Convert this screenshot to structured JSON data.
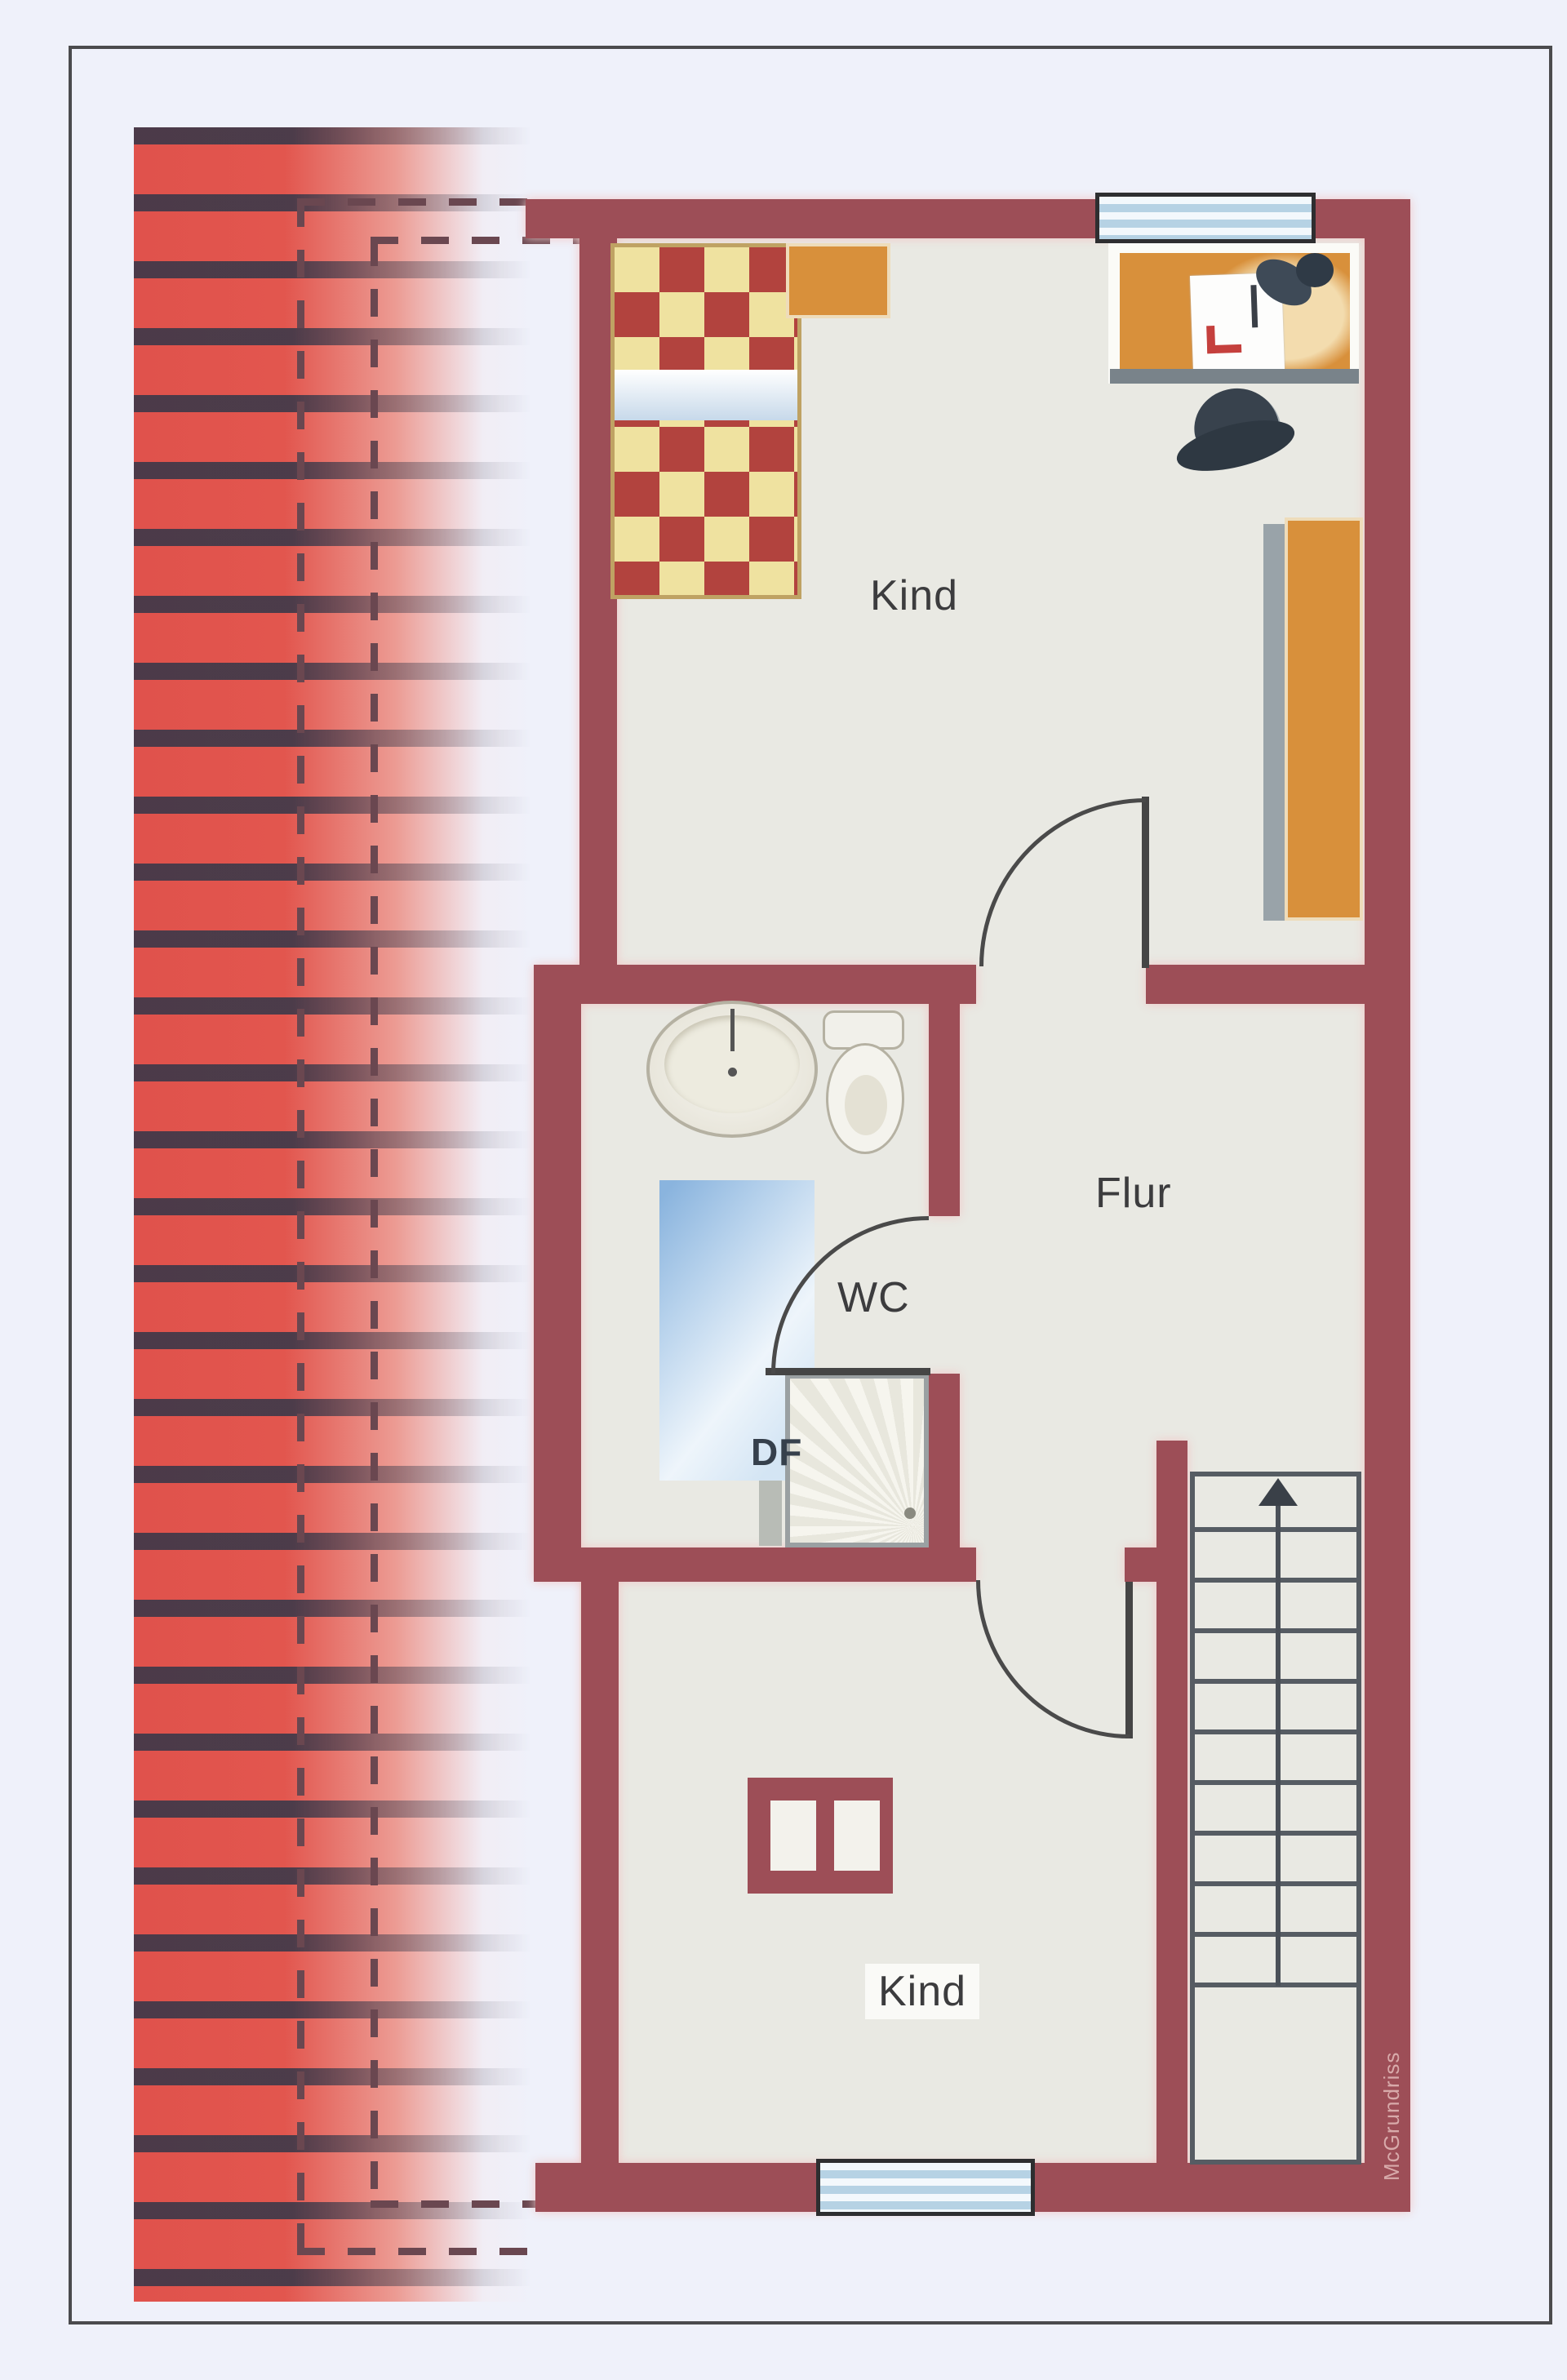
{
  "rooms": {
    "kind_top": "Kind",
    "flur": "Flur",
    "wc": "WC",
    "df": "DF",
    "kind_bottom": "Kind"
  },
  "watermark": "McGrundriss",
  "stairs": {
    "direction": "up"
  },
  "colors": {
    "wall": "#9d4e57",
    "floor": "#e9e9e3",
    "roof_red": "#e0524c",
    "roof_stripe": "#2e3649",
    "window_blue": "#b6d2e4",
    "furniture_wood": "#d8903b",
    "bed_check_red": "#b2433e",
    "bed_check_cream": "#efe2a0",
    "page_background": "#eff1fa",
    "dashed_line": "#6a4750",
    "watermark_text": "#d8aaaa"
  }
}
